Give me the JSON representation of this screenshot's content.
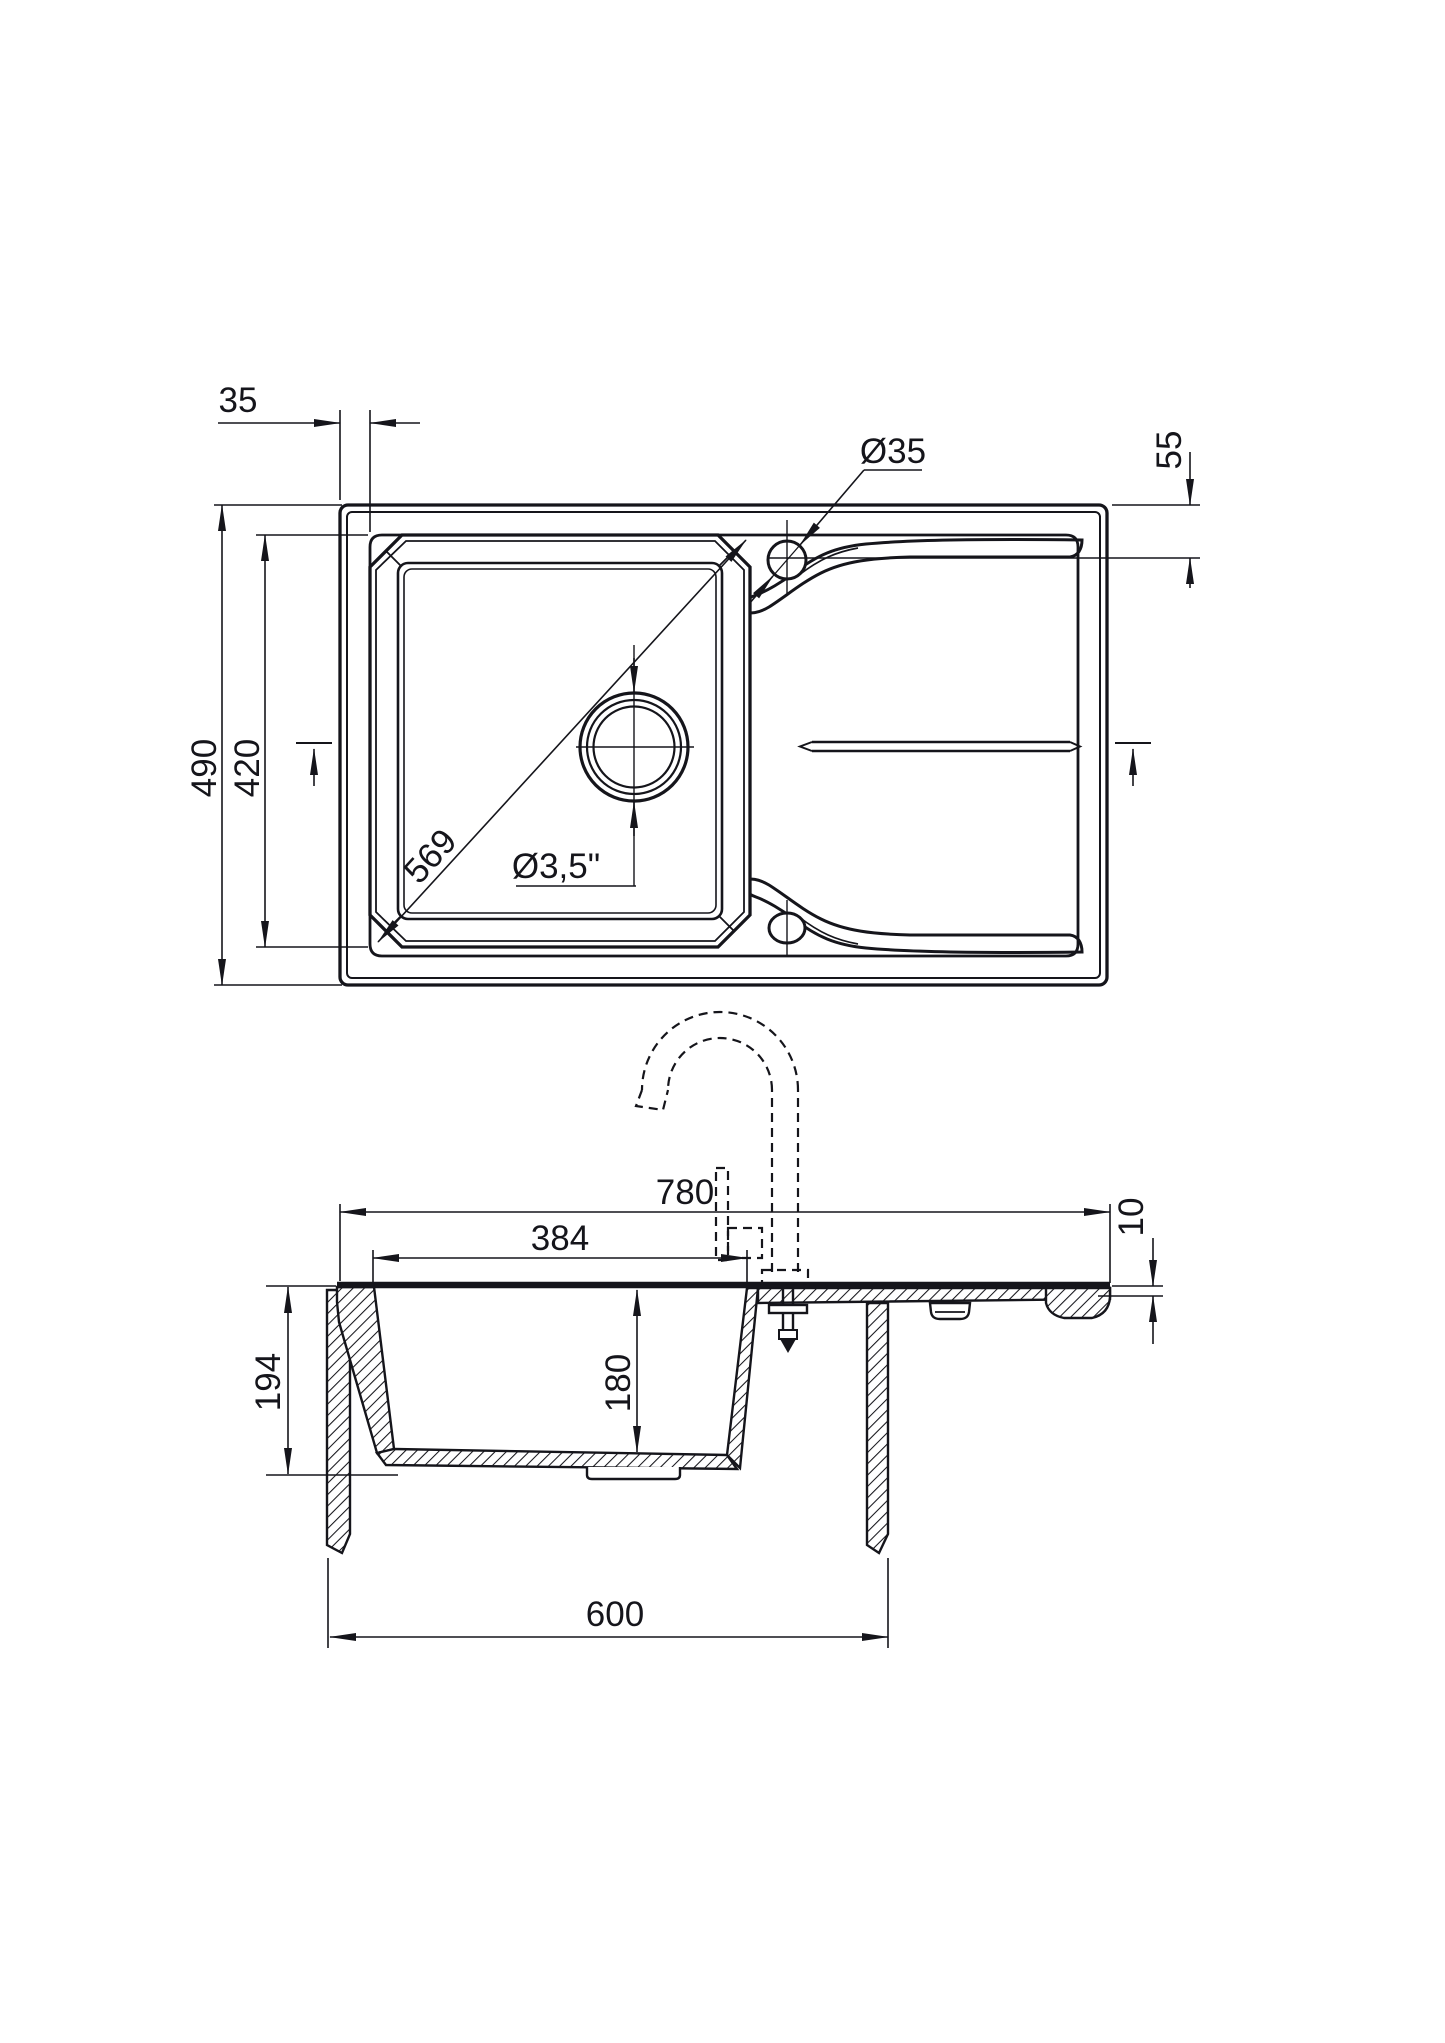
{
  "drawing": {
    "subject": "kitchen sink with drainboard - dimensional drawing, plan view and front section",
    "units_note": "mm",
    "plan": {
      "rim_offset": "35",
      "tap_hole_diameter": "Ø35",
      "hole_center_from_edge": "55",
      "overall_depth": "490",
      "bowl_length": "420",
      "bowl_diagonal": "569",
      "drain_diameter": "Ø3,5\""
    },
    "section": {
      "overall_width": "780",
      "bowl_width": "384",
      "rim_thickness": "10",
      "bowl_outer_depth": "194",
      "bowl_inner_depth": "180",
      "base_cabinet_width": "600"
    }
  }
}
